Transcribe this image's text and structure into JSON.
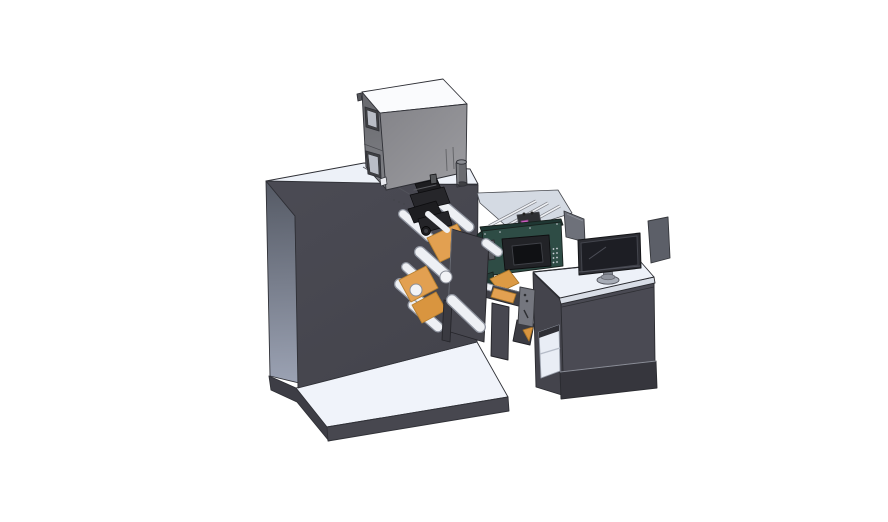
{
  "scene": {
    "kind": "3d-cad-render",
    "description": "Isometric CAD render of an industrial label printing and rewinding machine with operator desk",
    "background": "#ffffff"
  },
  "objects": [
    {
      "name": "base-platform"
    },
    {
      "name": "main-body"
    },
    {
      "name": "electrical-cabinet"
    },
    {
      "name": "glass-enclosure"
    },
    {
      "name": "control-panel-hmi"
    },
    {
      "name": "print-head-mechanism"
    },
    {
      "name": "web-rollers"
    },
    {
      "name": "outfeed-arm"
    },
    {
      "name": "operator-desk"
    },
    {
      "name": "side-panels"
    },
    {
      "name": "monitor"
    }
  ],
  "colors": {
    "background": "#ffffff",
    "top_surface": "#edf1f8",
    "platform_top": "#f0f3fa",
    "body_front": "#47474f",
    "platform_dark": "#3d3d45",
    "cabinet_top": "#fafbfd",
    "window_frame": "#3f4043",
    "window_glass": "#b9bdc6",
    "cylinder_gray": "#6a6b70",
    "teal_panel": "#2e4c45",
    "teal_dark": "#203733",
    "teal_sliver": "#1f3733",
    "teal_lower": "#223b36",
    "bezel": "#222327",
    "screen_dark": "#101114",
    "button_dot": "#cfd3da",
    "key_gray": "#585a60",
    "orange_web": "#e2a051",
    "orange_deep": "#d9953f",
    "orange_ramp": "#dc9a44",
    "roller": "#eef0f4",
    "roller_edge": "#9095a0",
    "dark_metal": "#1d1d20",
    "dark_metal2": "#26262a",
    "dark_metal3": "#242428",
    "plate": "#46464e",
    "bracket": "#3a3a41",
    "arm_bar": "#3f3f46",
    "handle_gray": "#74767e",
    "support_col": "#474750",
    "under_arm": "#3c3c43",
    "desk_front": "#4a4a53",
    "desk_side": "#44444c",
    "desk_slab": "#d8dde6",
    "skirt": "#36363d",
    "shelf_light": "#e9edf5",
    "panel_gray": "#6e717a",
    "panel_gray2": "#5c5f68",
    "monitor_bezel": "#2c2d33",
    "monitor_screen": "#1d1e24",
    "stand_gray": "#a7acb6",
    "stand_neck": "#7e828c",
    "enclosure_glass": "#ccd3de",
    "magenta_part": "#c95fc0",
    "edge": "#2f3036"
  }
}
